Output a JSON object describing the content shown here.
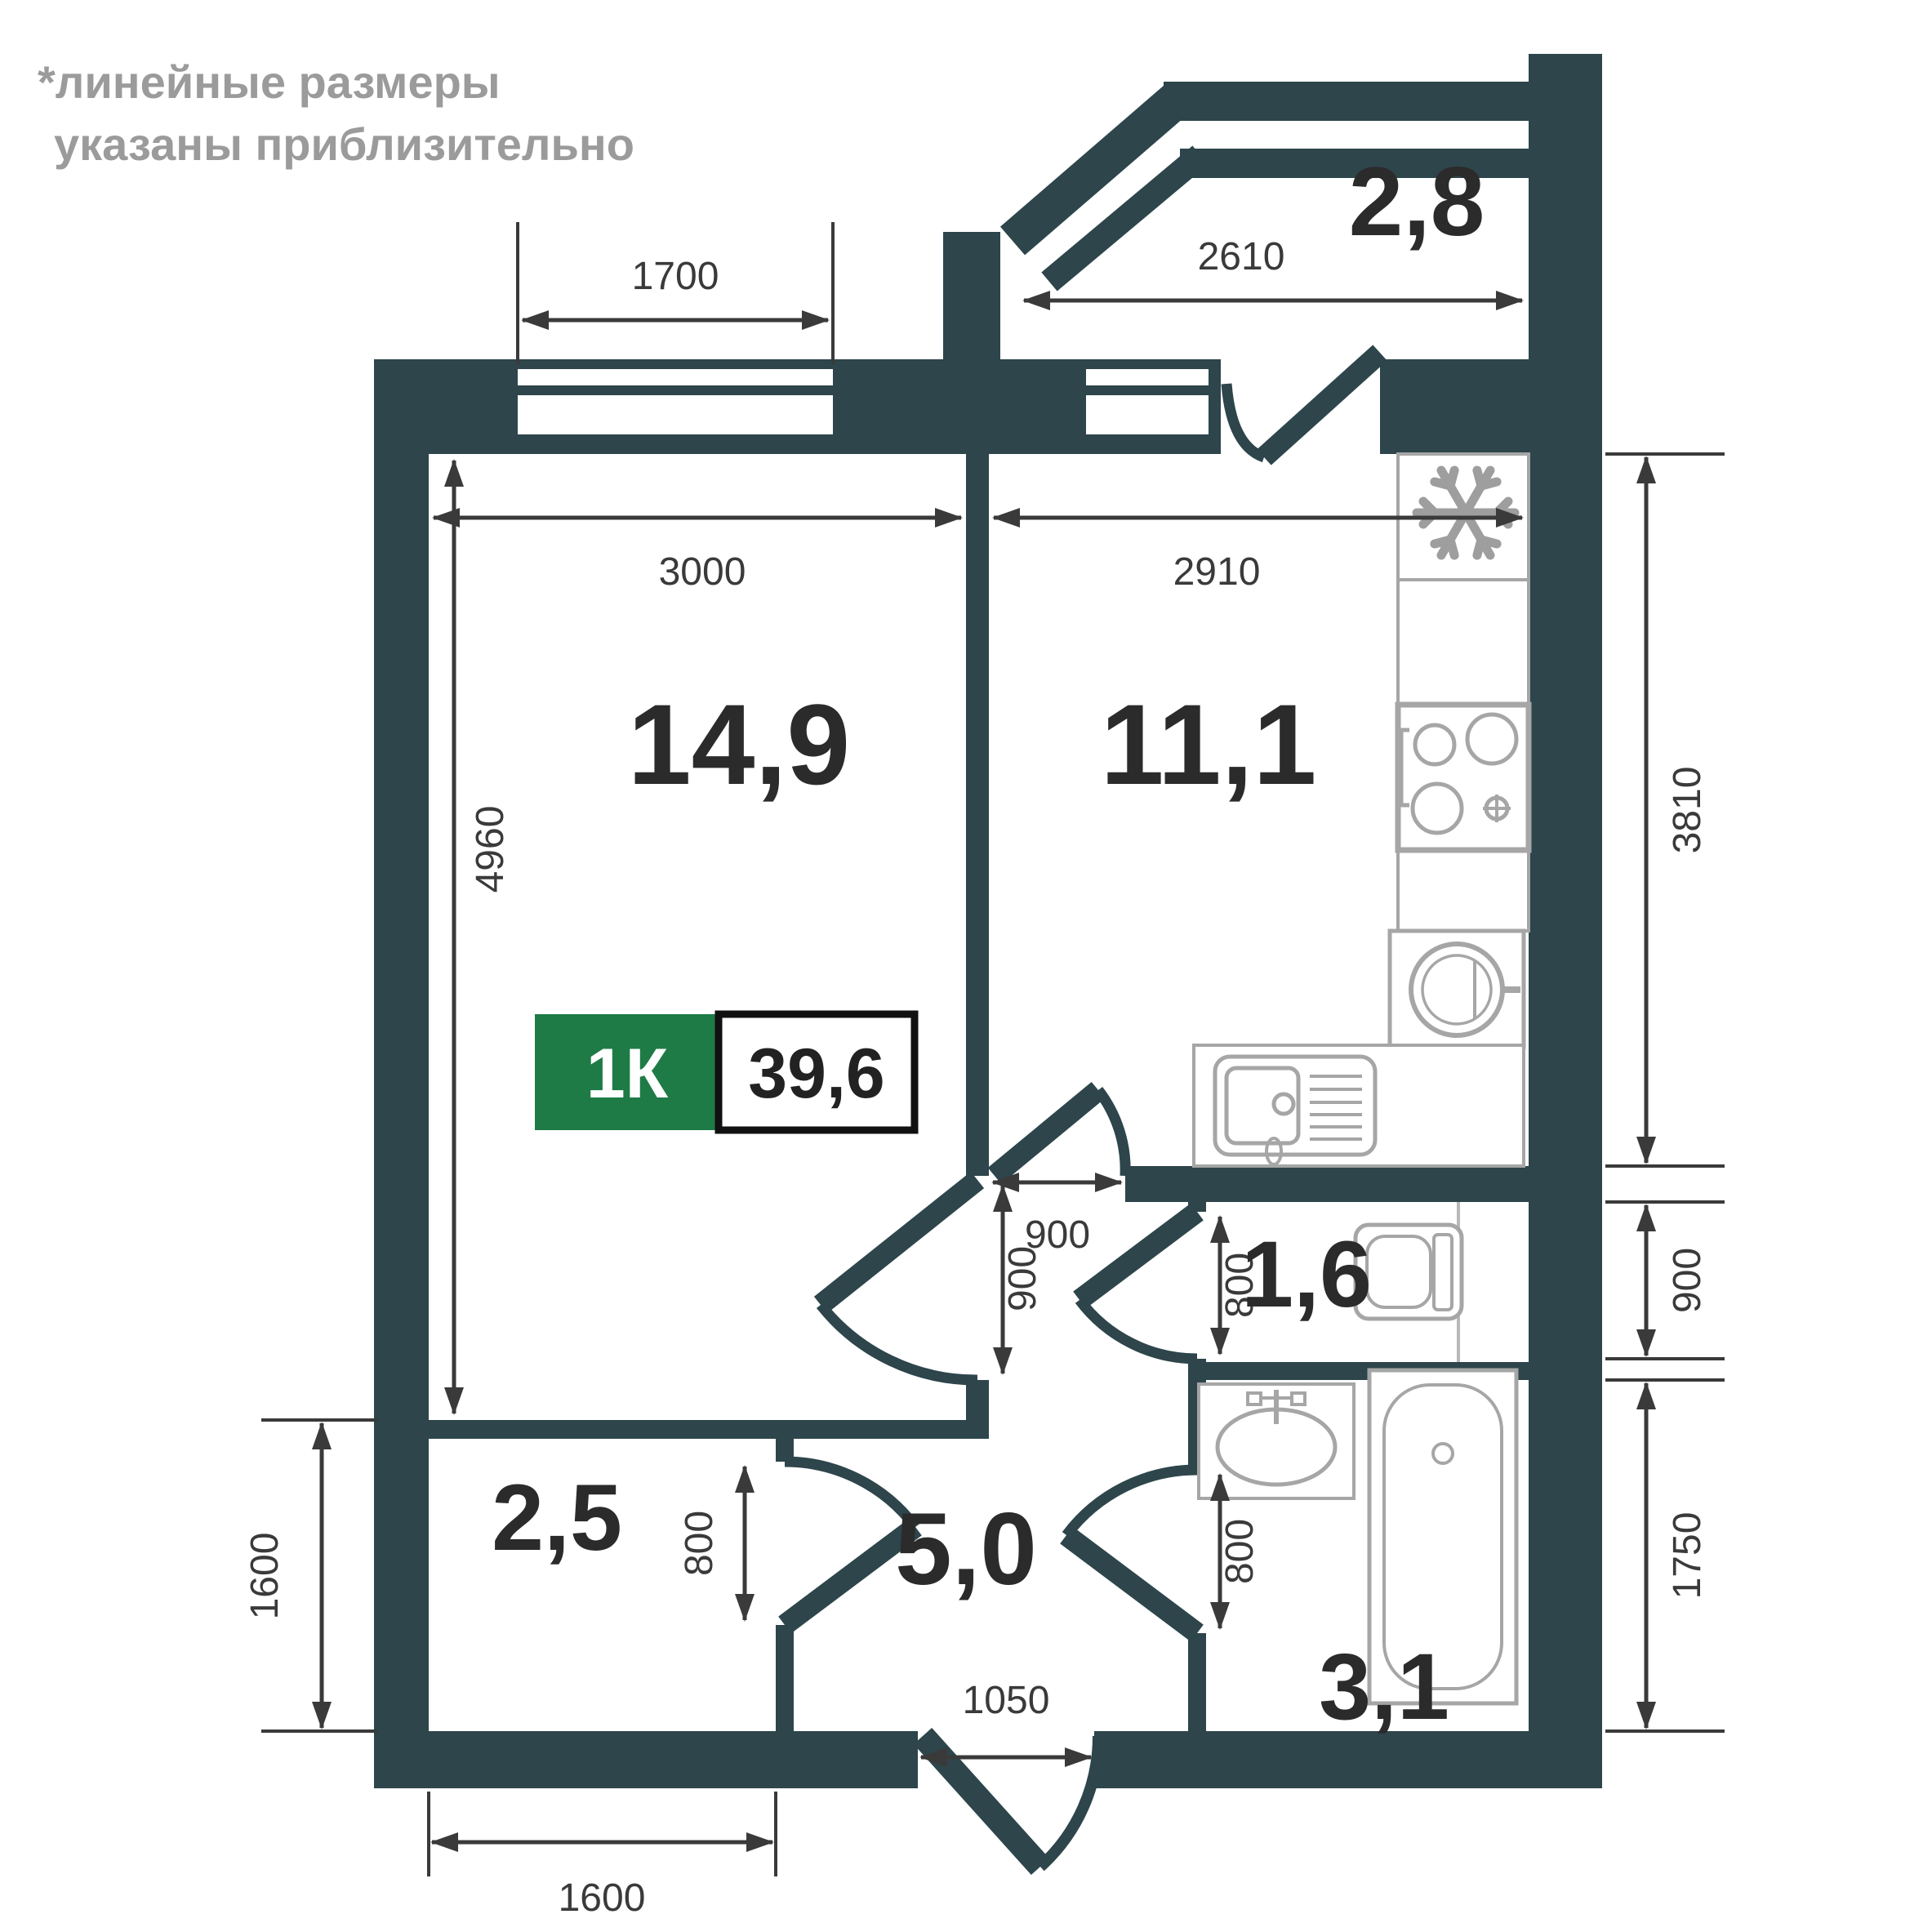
{
  "disclaimer": {
    "line1": "*линейные размеры",
    "line2": "указаны приблизительно"
  },
  "badge": {
    "type": "1К",
    "area": "39,6"
  },
  "rooms": {
    "living": {
      "area": "14,9"
    },
    "kitchen": {
      "area": "11,1"
    },
    "balcony": {
      "area": "2,8"
    },
    "wc": {
      "area": "1,6"
    },
    "storage": {
      "area": "2,5"
    },
    "hallway": {
      "area": "5,0"
    },
    "bathroom": {
      "area": "3,1"
    }
  },
  "dims": {
    "window_living": "1700",
    "balcony_width": "2610",
    "living_width": "3000",
    "kitchen_width": "2910",
    "living_depth": "4960",
    "kitchen_depth": "3810",
    "wc_depth": "900",
    "bathroom_depth": "1750",
    "storage_depth": "1600",
    "storage_width": "1600",
    "entrance_door": "1050",
    "kitchen_opening": "900",
    "living_door": "900",
    "wc_door": "800",
    "storage_door": "800",
    "bathroom_door": "800"
  },
  "colors": {
    "wall": "#2d454b",
    "fixture": "#a6a6a6",
    "dimension": "#3a3a3a",
    "label": "#2b2b2b",
    "disclaimer": "#9b9b9b",
    "badge_green": "#1e7b46"
  }
}
